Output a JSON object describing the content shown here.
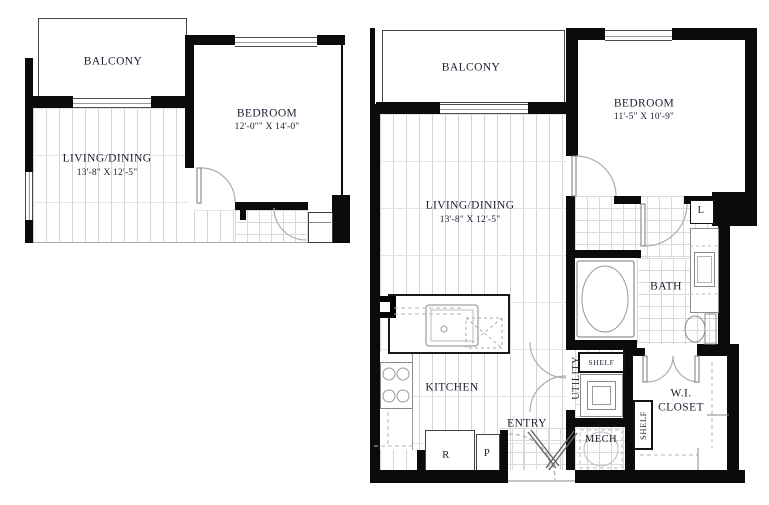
{
  "colors": {
    "wall": "#0b0b0b",
    "floor_line": "#d4d4d4",
    "text": "#1c1c30",
    "fixture": "#8a8a8a"
  },
  "plan_a": {
    "balcony": "BALCONY",
    "bedroom": "BEDROOM",
    "bedroom_dims": "12'-0\"\" X 14'-0\"",
    "living": "LIVING/DINING",
    "living_dims": "13'-8\" X 12'-5\""
  },
  "plan_b": {
    "balcony": "BALCONY",
    "bedroom": "BEDROOM",
    "bedroom_dims": "11'-5\" X 10'-9\"",
    "living": "LIVING/DINING",
    "living_dims": "13'-8\" X 12'-5\"",
    "kitchen": "KITCHEN",
    "bath": "BATH",
    "entry": "ENTRY",
    "utility": "UTILITY",
    "mech": "MECH",
    "wi_line1": "W.I.",
    "wi_line2": "CLOSET",
    "shelf_utility": "SHELF",
    "shelf_closet": "SHELF",
    "linen": "L",
    "refrigerator": "R",
    "pantry": "P"
  }
}
